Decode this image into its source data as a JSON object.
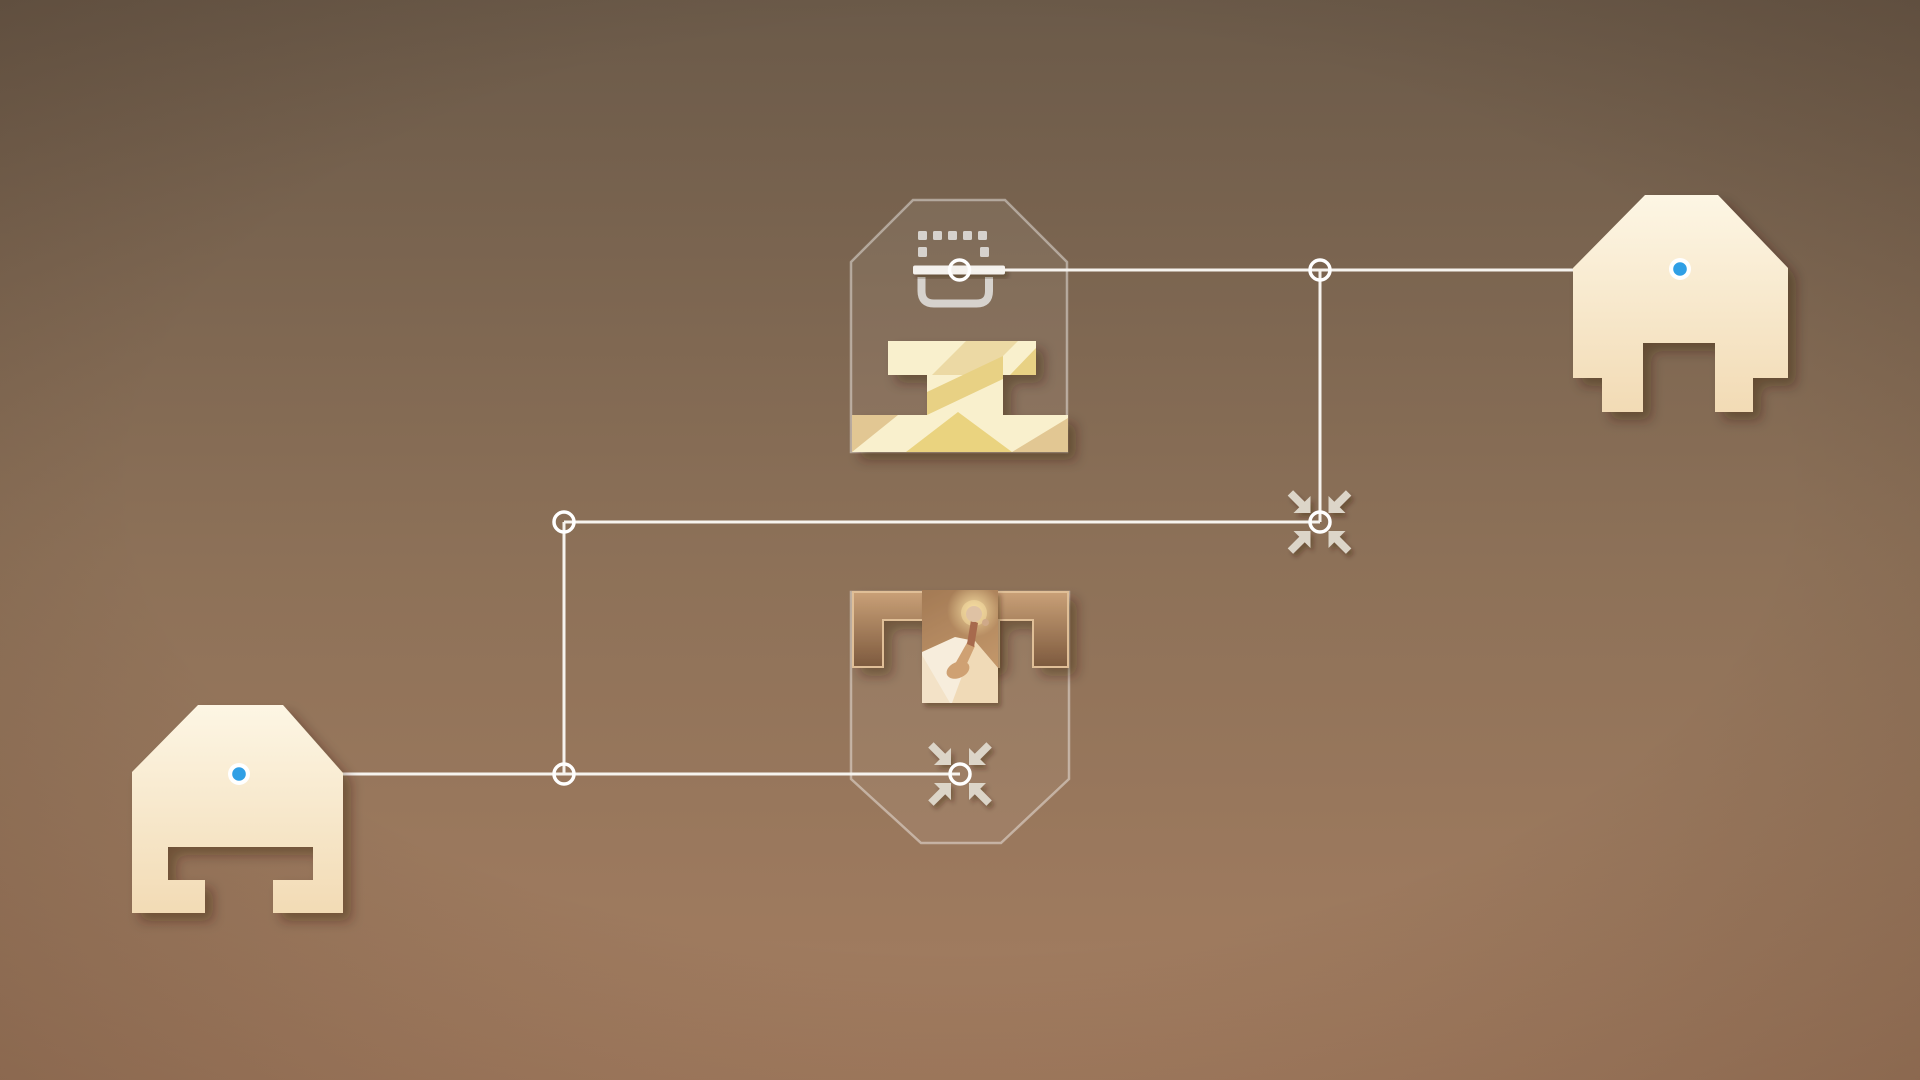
{
  "scene": {
    "type": "puzzle-game-chapter-map",
    "visible_text": [],
    "background": "warm-brown-vertical-gradient",
    "panels": [
      {
        "id": "top",
        "kind": "expanded-level-panel",
        "shape": "pentagon-roof",
        "icon": "dashed-crate-icon",
        "thumbnail": "cream-monument-ibeam",
        "junction": "ring-on-icon-bar"
      },
      {
        "id": "bottom",
        "kind": "expanded-level-panel",
        "shape": "shield-tapered-bottom",
        "icon": "collapse-arrows-icon",
        "thumbnail": "figure-on-glowing-dune",
        "junction": "ring-in-collapse-arrows"
      }
    ],
    "gates": [
      {
        "id": "left",
        "kind": "chapter-gate-totem",
        "indicator": "blue-dot"
      },
      {
        "id": "right",
        "kind": "chapter-gate-totem",
        "indicator": "blue-dot"
      }
    ],
    "collapse_buttons": [
      {
        "id": "mid-right-junction",
        "icon": "collapse-arrows-icon"
      },
      {
        "id": "bottom-panel",
        "icon": "collapse-arrows-icon"
      }
    ],
    "junction_ring_count": 6,
    "connector_count": 5
  },
  "theme": {
    "colors": {
      "bg-top": "#6b5a49",
      "bg-mid": "#8d7158",
      "bg-bottom": "#a57e61",
      "line": "#f6f3ee",
      "ring": "#ffffff",
      "panel-stroke": "rgba(255,255,255,0.42)",
      "panel-fill": "rgba(255,255,255,0.06)",
      "totem-top": "#fdf6e4",
      "totem-bottom": "#f2dbb5",
      "dot-blue": "#2f9fe5",
      "dot-ring": "#ffffff",
      "arrow": "#dcd5c8",
      "icon-gray": "#d6d2cd",
      "icon-bar": "#f4f1ed",
      "block-top": "#c9a077",
      "block-bottom": "#7d5a3e",
      "block-stroke": "#e0bf97",
      "sky-top": "#a37a55",
      "sky-bottom": "#c69a6c",
      "glow": "#f7dfa3",
      "dune": "#f7eddc",
      "dune-shade": "#edd5ae",
      "figure-shadow": "#cfa173",
      "figure-body": "#a76a4e",
      "figure-head": "#dfc2a4",
      "figure-head2": "#cfa988",
      "thumb-cream": "#f9f0cd",
      "thumb-tan": "#e2c793",
      "thumb-tan2": "#ecd9a4",
      "thumb-gold": "#ead37f",
      "thumb-gold2": "#e8d184",
      "shadow": "#321905"
    }
  }
}
